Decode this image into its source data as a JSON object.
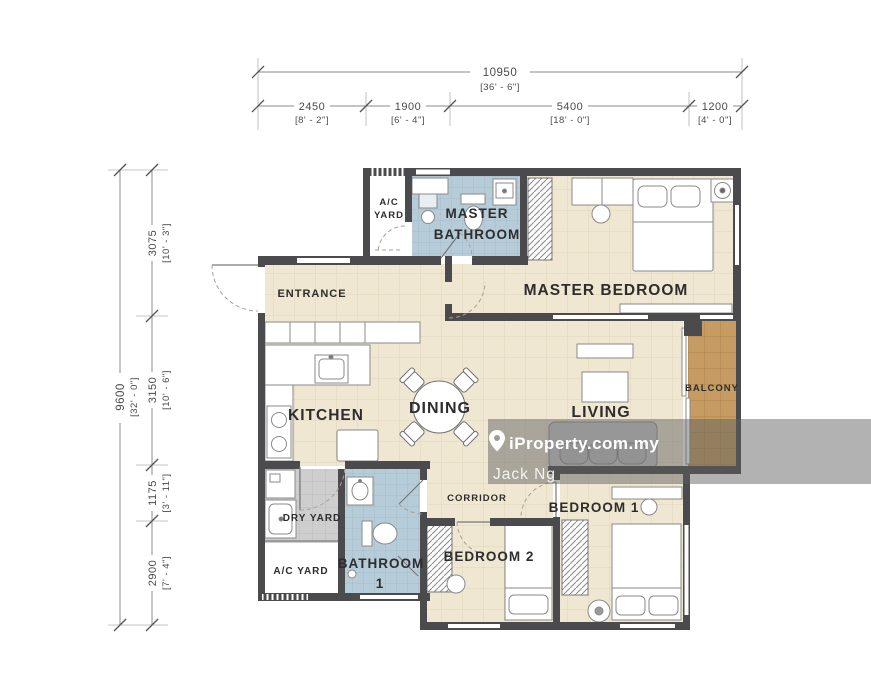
{
  "labels": {
    "entrance": "ENTRANCE",
    "ac_yard_top_1": "A/C",
    "ac_yard_top_2": "YARD",
    "master_bathroom_1": "MASTER",
    "master_bathroom_2": "BATHROOM",
    "master_bedroom": "MASTER BEDROOM",
    "kitchen": "KITCHEN",
    "dining": "DINING",
    "living": "LIVING",
    "balcony": "BALCONY",
    "dry_yard": "DRY YARD",
    "ac_yard_bottom": "A/C YARD",
    "bathroom1_1": "BATHROOM",
    "bathroom1_2": "1",
    "corridor": "CORRIDOR",
    "bedroom1": "BEDROOM 1",
    "bedroom2": "BEDROOM 2"
  },
  "dimensions": {
    "top": {
      "overall": {
        "mm": "10950",
        "ft": "[36' - 6\"]"
      },
      "segments": [
        {
          "mm": "2450",
          "ft": "[8' - 2\"]"
        },
        {
          "mm": "1900",
          "ft": "[6' - 4\"]"
        },
        {
          "mm": "5400",
          "ft": "[18' - 0\"]"
        },
        {
          "mm": "1200",
          "ft": "[4' - 0\"]"
        }
      ]
    },
    "left": {
      "overall": {
        "mm": "9600",
        "ft": "[32' - 0\"]"
      },
      "segments": [
        {
          "mm": "3075",
          "ft": "[10' - 3\"]"
        },
        {
          "mm": "3150",
          "ft": "[10' - 6\"]"
        },
        {
          "mm": "1175",
          "ft": "[3' - 11\"]"
        },
        {
          "mm": "2900",
          "ft": "[7' - 4\"]"
        }
      ]
    }
  },
  "watermark": {
    "brand": "iProperty.com.my",
    "agent": "Jack Ng",
    "pin_icon": "map-pin"
  },
  "colors": {
    "wall": "#4b4b4e",
    "floor_tile": "#efe7d2",
    "floor_grid": "#e0d6bb",
    "bathroom_tile": "#b7ccd9",
    "bathroom_grid": "#a4bbc9",
    "dry_yard_tile": "#cecece",
    "balcony_wood": "#c69c63",
    "watermark_band": "rgba(95,95,95,0.48)",
    "watermark_text": "#ffffff",
    "dimension_text": "#4a4a4a",
    "label_text": "#2d2d2d"
  }
}
